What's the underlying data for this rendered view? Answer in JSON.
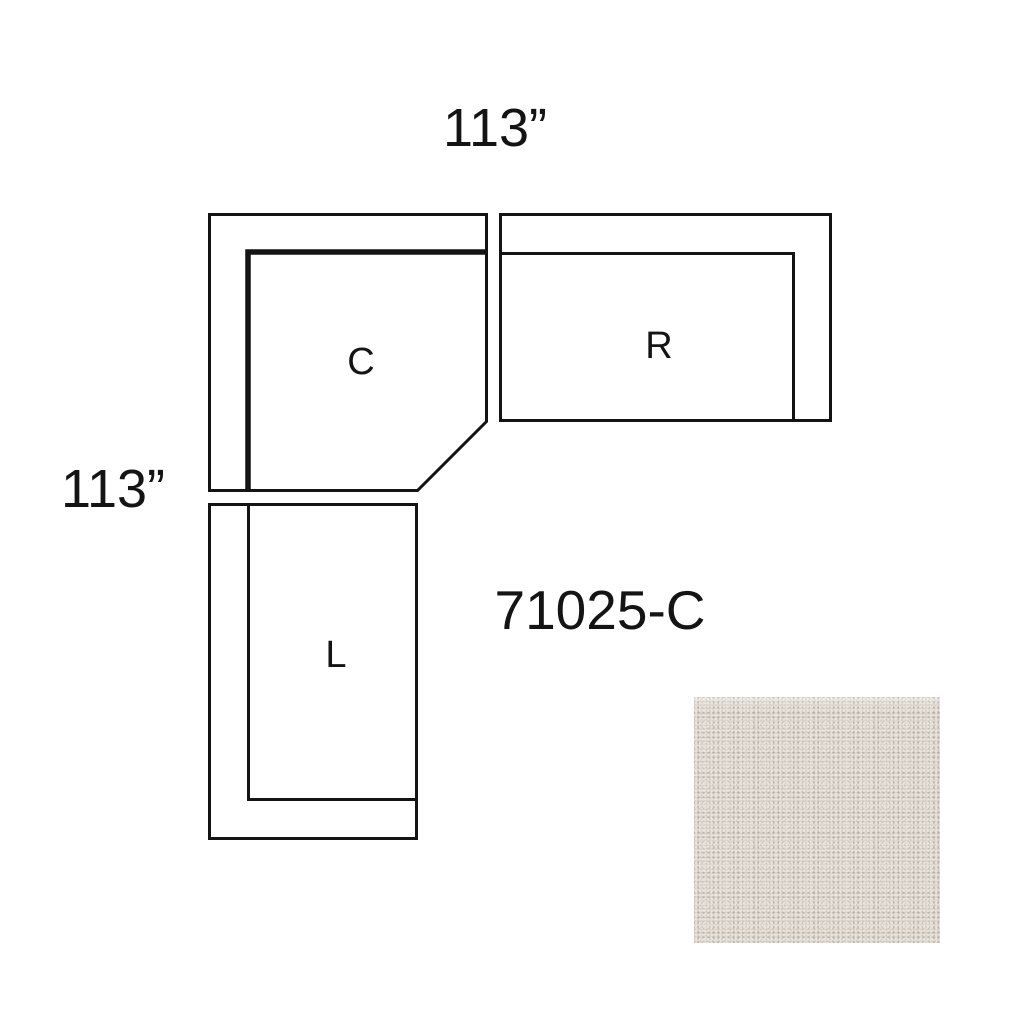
{
  "canvas": {
    "width_px": 1024,
    "height_px": 1023,
    "background_color": "#ffffff"
  },
  "diagram": {
    "product_code": "71025-C",
    "dimension_top": "113”",
    "dimension_left": "113”",
    "line_color": "#141414",
    "text_color": "#141414",
    "pieces": [
      {
        "id": "corner",
        "label": "C"
      },
      {
        "id": "right-arm-section",
        "label": "R"
      },
      {
        "id": "left-arm-section",
        "label": "L"
      }
    ]
  },
  "swatch": {
    "base_color": "#d5cfc7",
    "light_color": "#e9e4dc",
    "dark_color": "#b8b0a5"
  }
}
